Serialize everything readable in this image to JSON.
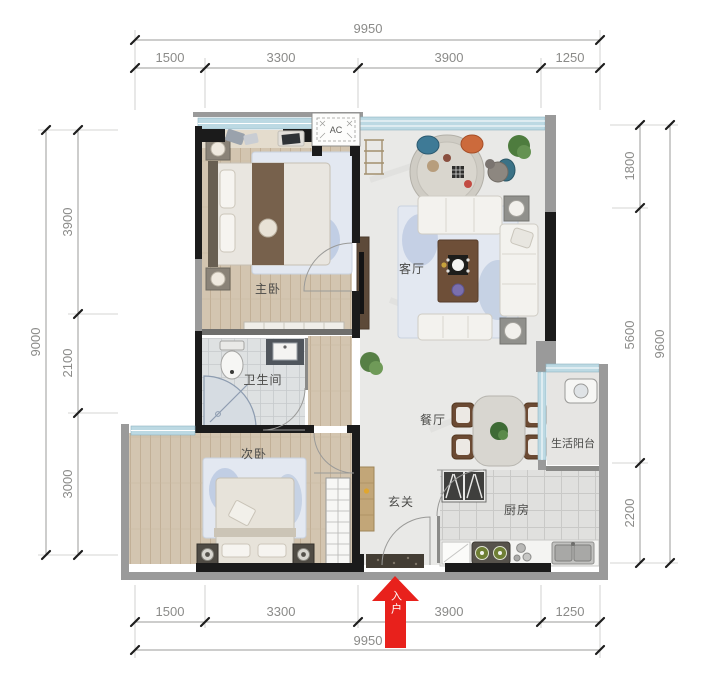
{
  "title": "apartment-floor-plan",
  "dimensions": {
    "top": {
      "total": "9950",
      "segments": [
        "1500",
        "3300",
        "3900",
        "1250"
      ]
    },
    "bottom": {
      "total": "9950",
      "segments": [
        "1500",
        "3300",
        "3900",
        "1250"
      ]
    },
    "left": {
      "total": "9000",
      "segments": [
        "3900",
        "2100",
        "3000"
      ]
    },
    "right": {
      "total": "9600",
      "segments": [
        "1800",
        "5600",
        "2200"
      ]
    }
  },
  "rooms": {
    "master_bedroom": "主卧",
    "bathroom": "卫生间",
    "second_bedroom": "次卧",
    "living_room": "客厅",
    "dining_room": "餐厅",
    "balcony": "生活阳台",
    "kitchen": "厨房",
    "entry": "玄关"
  },
  "annotations": {
    "ac_unit": "AC",
    "entrance_arrow": "入户"
  },
  "colors": {
    "wall_black": "#1b1b1b",
    "wall_gray": "#9a9a9a",
    "window_blue": "#bcd9e3",
    "arrow_red": "#e8211c",
    "wood_floor": "#d3c5b0",
    "dimension_text": "#8b8b89",
    "room_label_text": "#4a4a48"
  }
}
